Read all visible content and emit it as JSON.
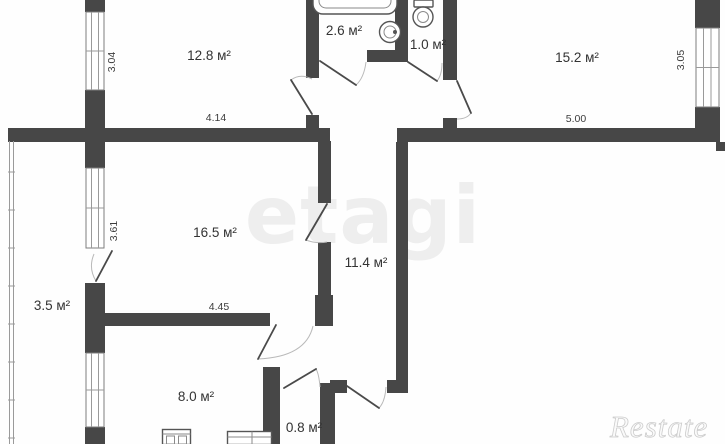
{
  "plan": {
    "rooms": [
      {
        "name": "living-room-top-left",
        "area": "12.8 м²"
      },
      {
        "name": "bathroom",
        "area": "2.6 м²"
      },
      {
        "name": "wc",
        "area": "1.0 м²"
      },
      {
        "name": "living-room-top-right",
        "area": "15.2 м²"
      },
      {
        "name": "living-room-middle",
        "area": "16.5 м²"
      },
      {
        "name": "hallway",
        "area": "11.4 м²"
      },
      {
        "name": "balcony",
        "area": "3.5 м²"
      },
      {
        "name": "kitchen",
        "area": "8.0 м²"
      },
      {
        "name": "storage",
        "area": "0.8 м²"
      }
    ],
    "dimensions": [
      {
        "value": "3.04",
        "orientation": "vertical"
      },
      {
        "value": "4.14",
        "orientation": "horizontal"
      },
      {
        "value": "5.00",
        "orientation": "horizontal"
      },
      {
        "value": "3.05",
        "orientation": "vertical"
      },
      {
        "value": "3.61",
        "orientation": "vertical"
      },
      {
        "value": "4.45",
        "orientation": "horizontal"
      }
    ],
    "watermark_center": "etagi",
    "watermark_corner": "Restate",
    "icons": [
      "bathtub-icon",
      "washbasin-icon",
      "toilet-icon",
      "stove-icon",
      "kitchen-counter-icon"
    ],
    "colors": {
      "wall": "#474747",
      "room_label": "#333333",
      "dimension_label": "#3c3c3c",
      "watermark": "#eeeeee",
      "background": "#ffffff"
    }
  }
}
